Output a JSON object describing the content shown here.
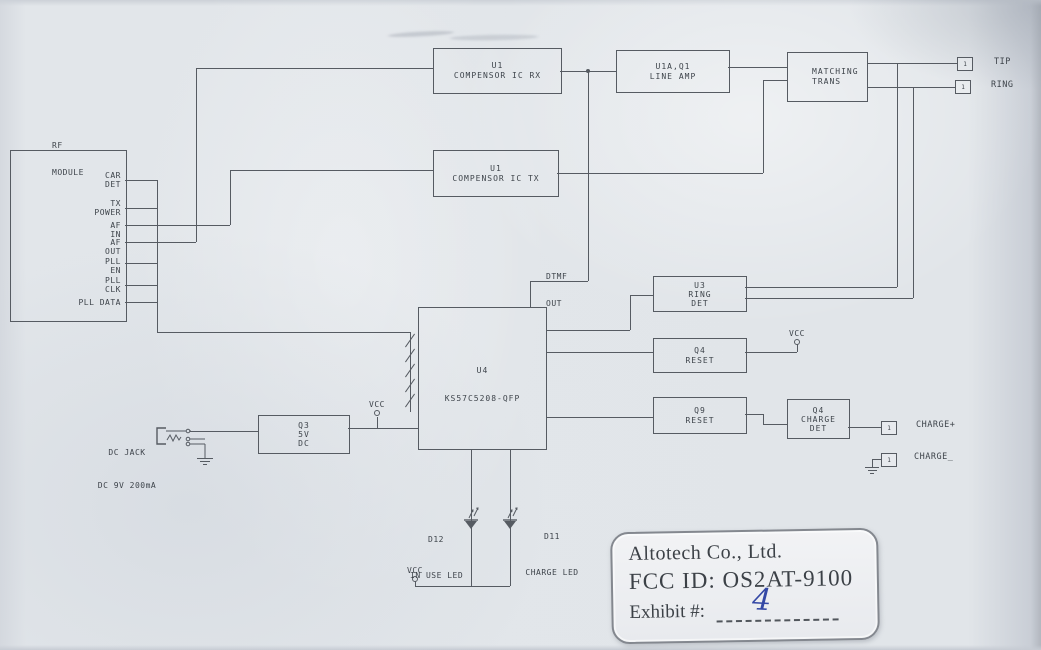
{
  "diagram": {
    "rf_module": {
      "title": [
        "RF",
        "MODULE"
      ],
      "pins": [
        [
          "CAR",
          "DET"
        ],
        [
          "TX",
          "POWER"
        ],
        [
          "AF",
          "IN"
        ],
        [
          "AF",
          "OUT"
        ],
        [
          "PLL",
          "EN"
        ],
        [
          "PLL",
          "CLK"
        ],
        [
          "PLL DATA",
          ""
        ]
      ]
    },
    "blocks": {
      "compensor_rx": [
        "U1",
        "COMPENSOR IC RX"
      ],
      "line_amp": [
        "U1A,Q1",
        "LINE AMP"
      ],
      "matching_trans": [
        "MATCHING",
        "TRANS"
      ],
      "compensor_tx": [
        "U1",
        "COMPENSOR IC TX"
      ],
      "ring_det": [
        "U3",
        "RING",
        "DET"
      ],
      "q4_reset": [
        "Q4",
        "RESET"
      ],
      "q9_reset": [
        "Q9",
        "RESET"
      ],
      "charge_det": [
        "Q4",
        "CHARGE",
        "DET"
      ],
      "mcu": [
        "U4",
        "KS57C5208-QFP"
      ],
      "regulator": [
        "Q3",
        "5V",
        "DC"
      ]
    },
    "labels": {
      "dtmf": [
        "DTMF",
        "OUT"
      ],
      "tip": "TIP",
      "ring": "RING",
      "pin1": "1",
      "vcc": "VCC",
      "charge_plus": "CHARGE+",
      "charge_minus": "CHARGE_",
      "dc_jack": [
        "DC JACK",
        "DC 9V 200mA"
      ],
      "in_use_led": [
        "D12",
        "IN USE LED"
      ],
      "charge_led": [
        "D11",
        "CHARGE LED"
      ]
    }
  },
  "stamp": {
    "company": "Altotech Co., Ltd.",
    "fcc_id": "FCC ID: OS2AT-9100",
    "exhibit_label": "Exhibit #:",
    "exhibit_value": "4"
  },
  "colors": {
    "paper": "#dfe3e8",
    "wire": "#565b62",
    "ink": "#3e444b",
    "handwriting": "#3448a5"
  }
}
